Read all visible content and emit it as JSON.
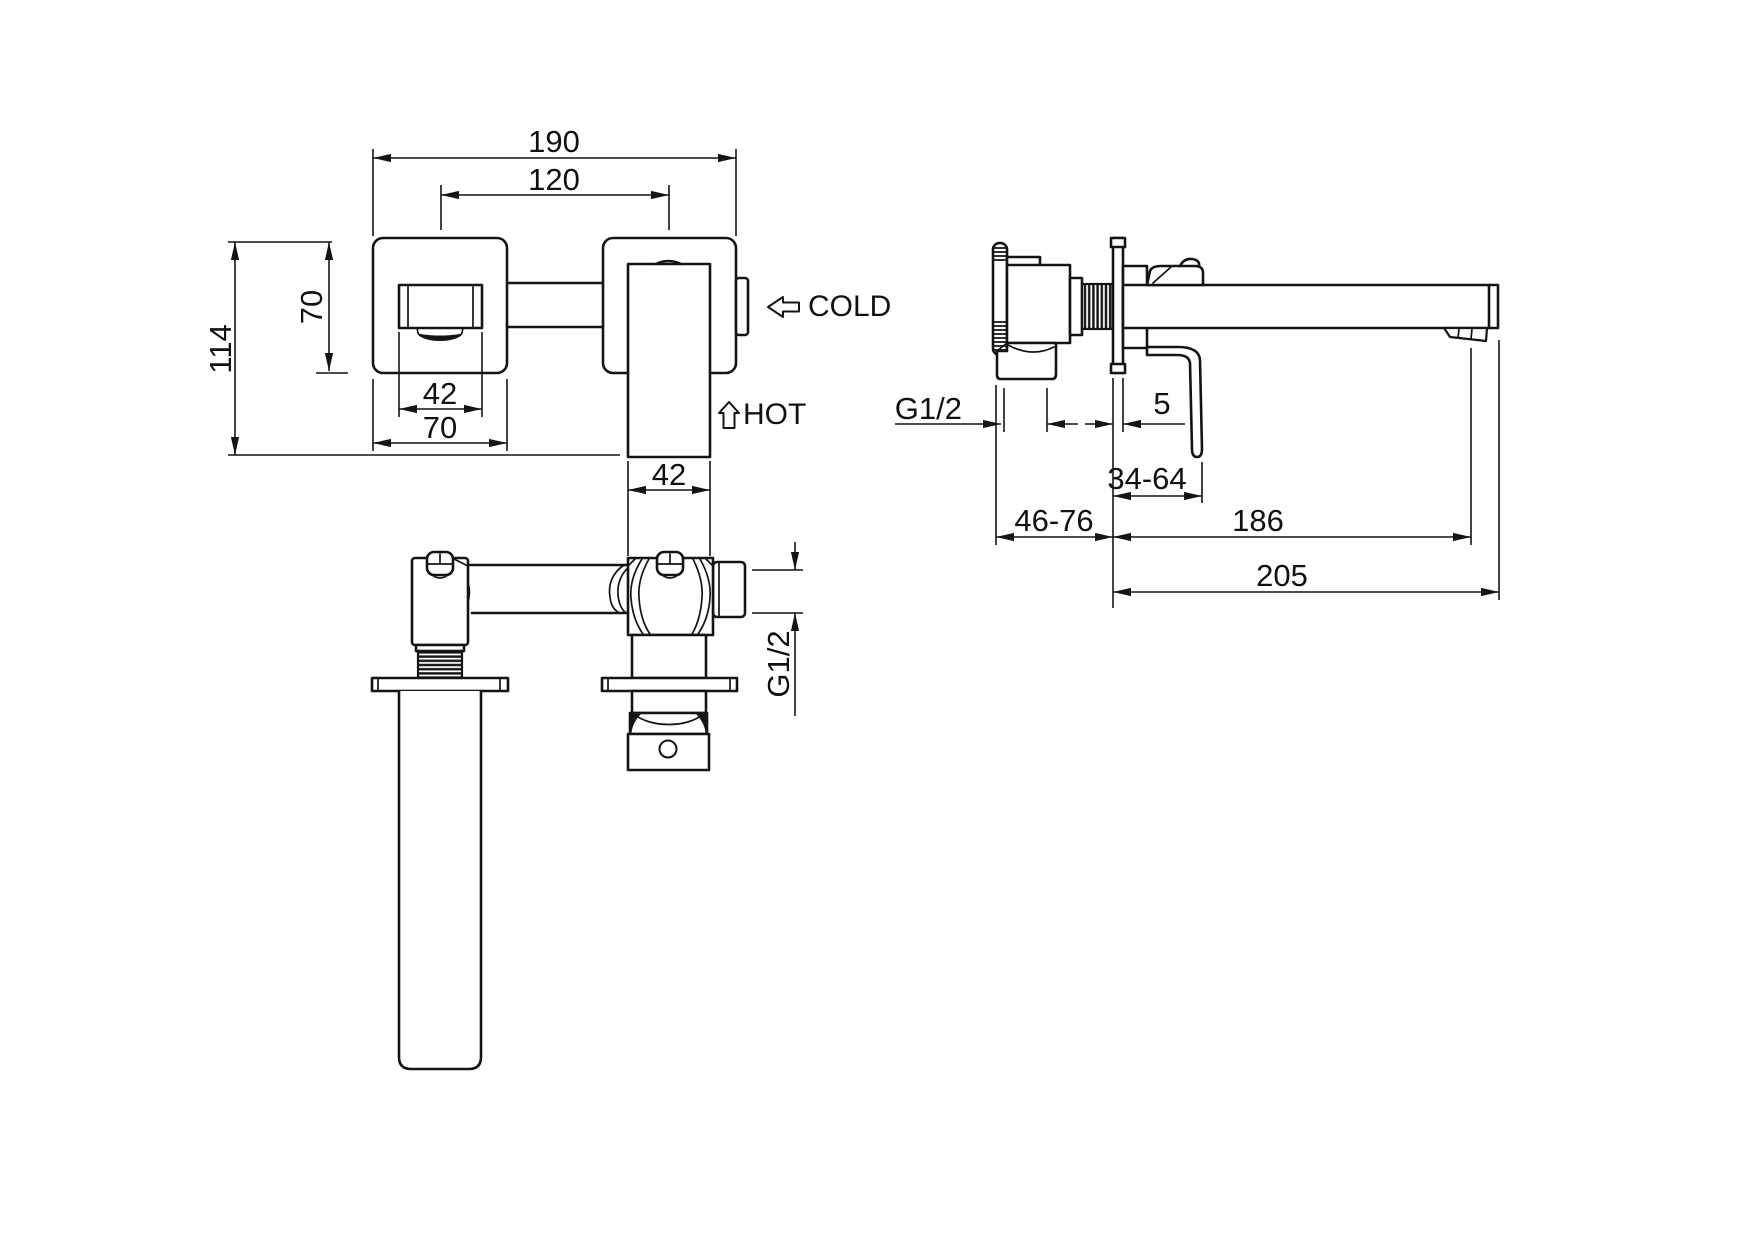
{
  "page": {
    "background": "#ffffff",
    "line_color": "#141414",
    "text_color": "#111111"
  },
  "views": {
    "front": {
      "dims": {
        "overall_width": "190",
        "port_spacing": "120",
        "plate_height": "70",
        "overall_height": "114",
        "spout_width": "42",
        "plate_width": "70",
        "handle_width": "42"
      },
      "flow": {
        "cold": "COLD",
        "hot": "HOT"
      }
    },
    "side": {
      "dims": {
        "inlet_thread": "G1/2",
        "plate_thickness": "5",
        "handle_offset_range": "34-64",
        "install_depth_range": "46-76",
        "spout_reach": "186",
        "overall_depth": "205"
      }
    },
    "bottom": {
      "dims": {
        "outlet_thread": "G1/2"
      }
    }
  }
}
